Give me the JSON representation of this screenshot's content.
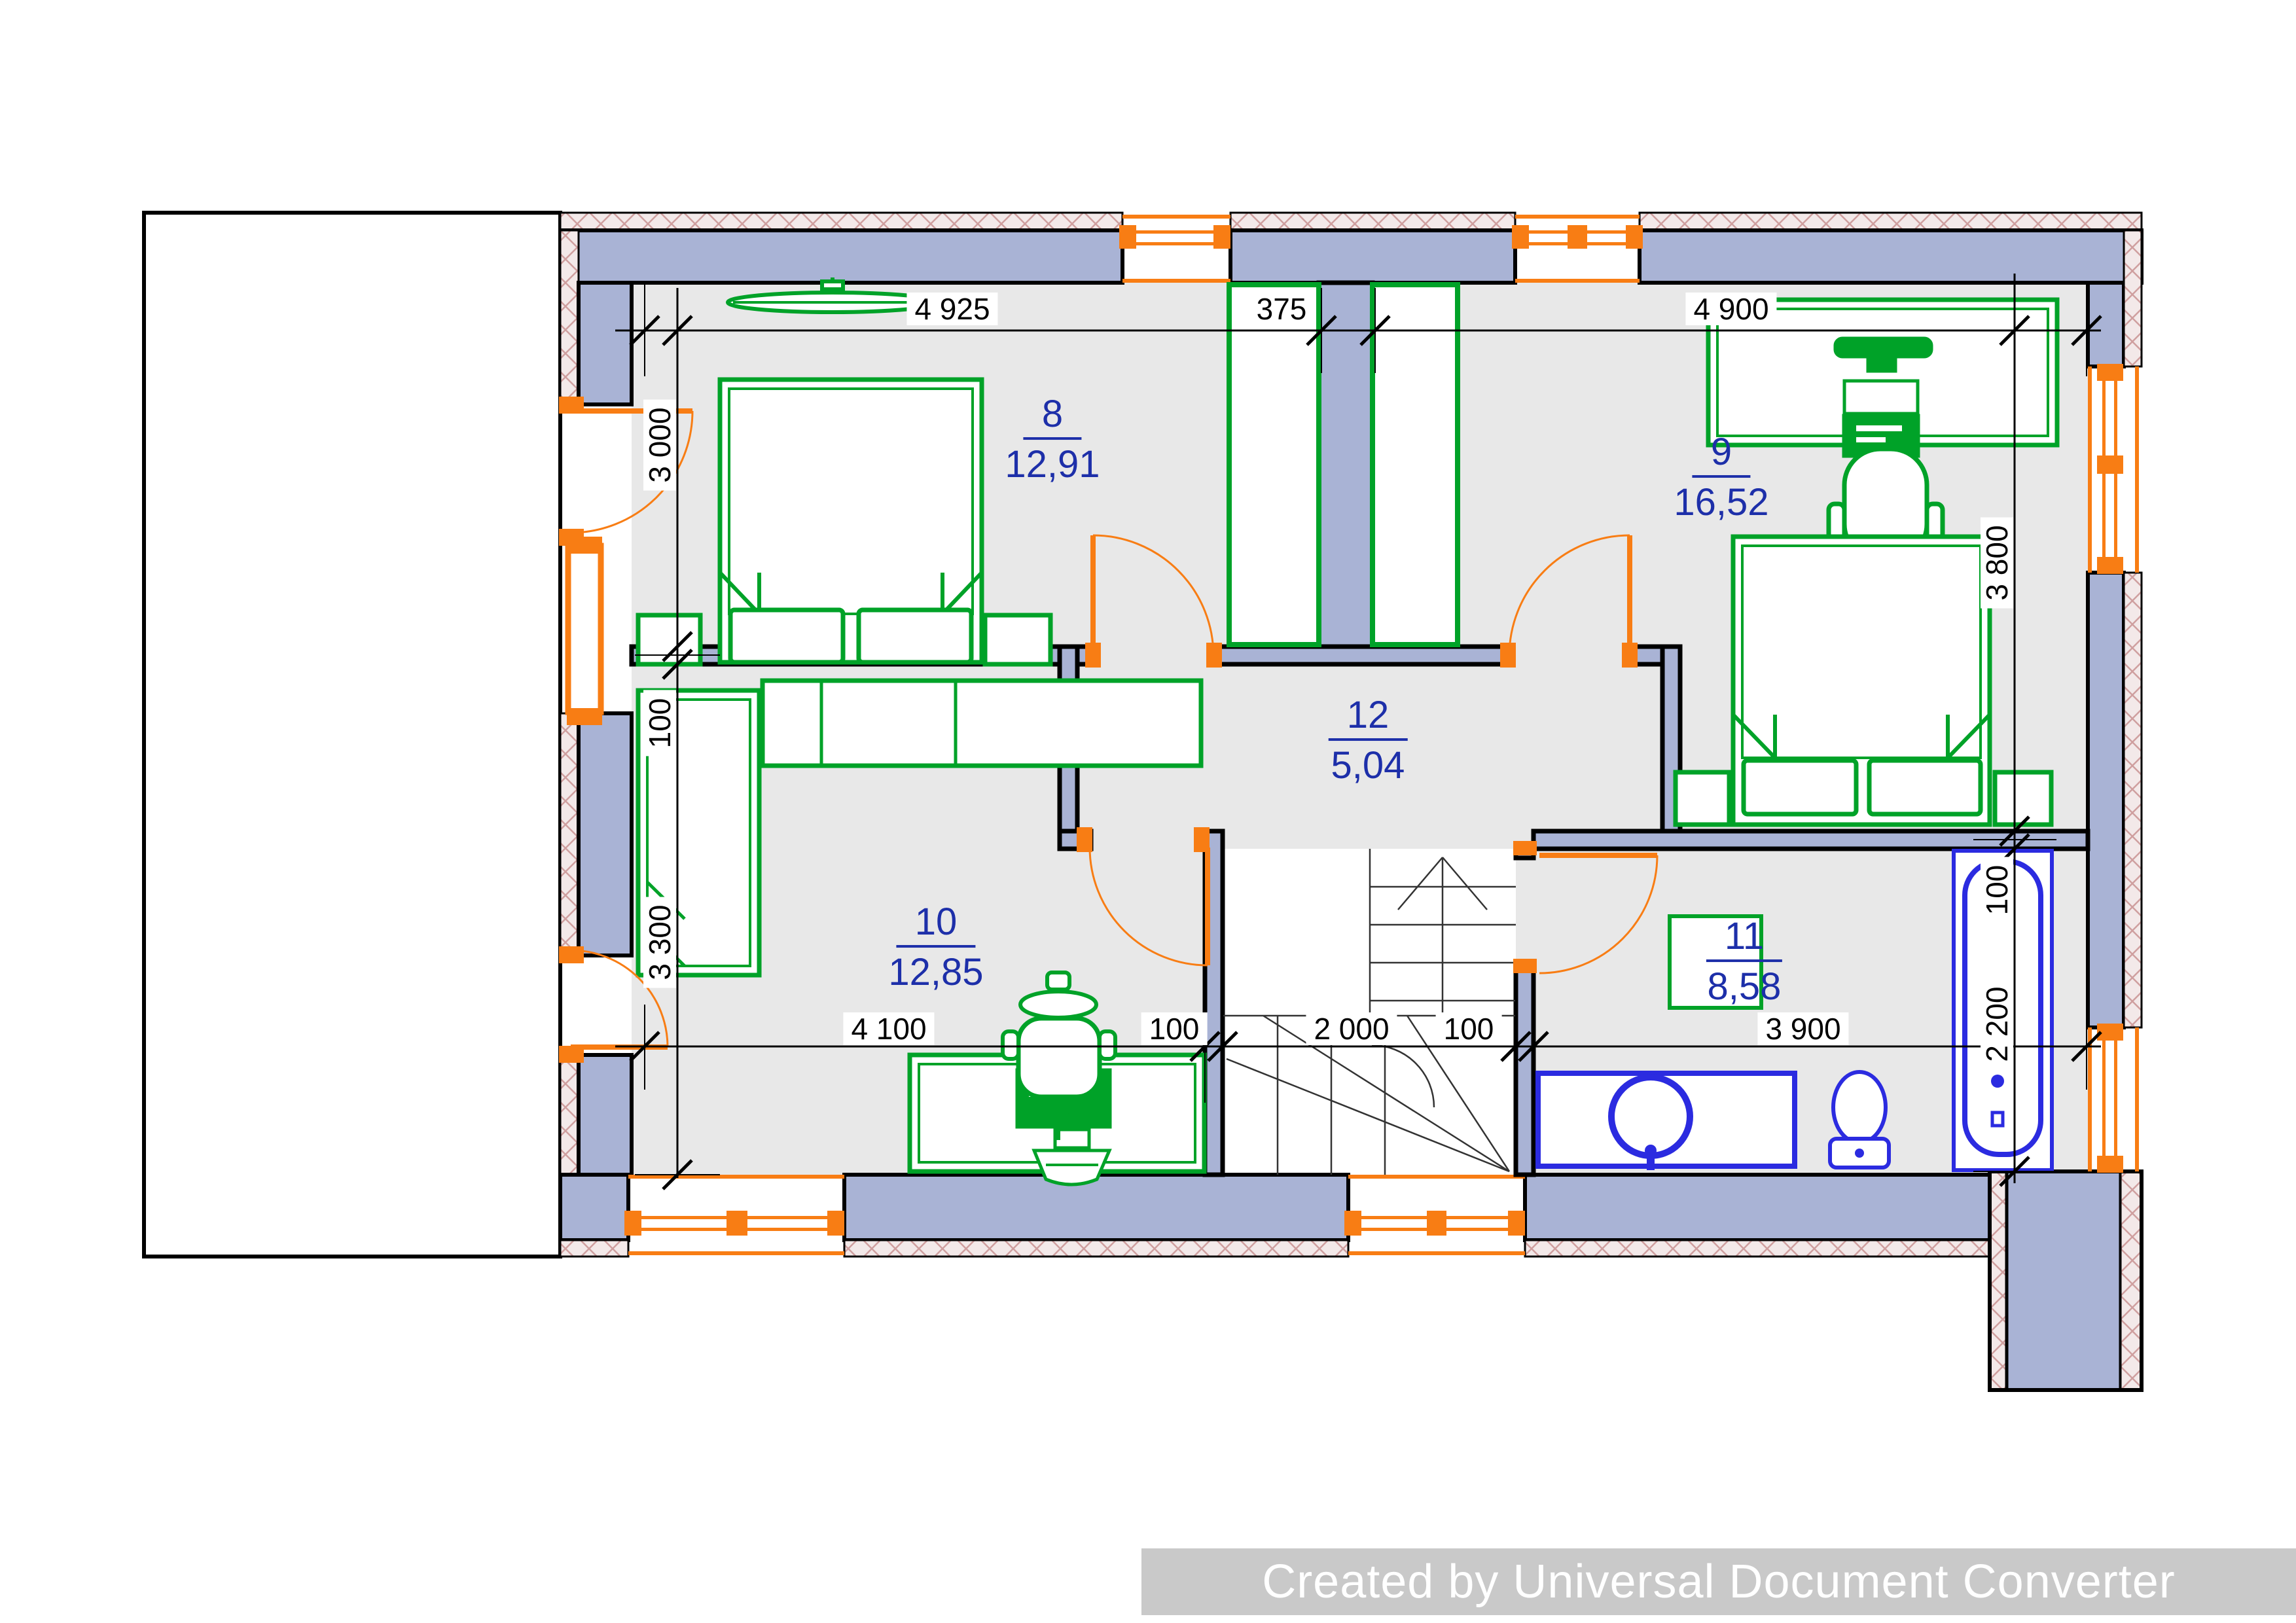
{
  "watermark": {
    "text": "Created by Universal Document Converter"
  },
  "rooms": [
    {
      "number": "8",
      "area": "12,91"
    },
    {
      "number": "9",
      "area": "16,52"
    },
    {
      "number": "10",
      "area": "12,85"
    },
    {
      "number": "11",
      "area": "8,58"
    },
    {
      "number": "12",
      "area": "5,04"
    }
  ],
  "dims": {
    "top": [
      "4 925",
      "375",
      "4 900"
    ],
    "bottom": [
      "4 100",
      "100",
      "2 000",
      "100",
      "3 900"
    ],
    "left": [
      "3 000",
      "100",
      "3 300"
    ],
    "right": [
      "3 800",
      "100",
      "2 200"
    ]
  },
  "colors": {
    "wall_fill": "#a9b3d5",
    "insulation_hatch": "#f3e9e9",
    "floor": "#e8e8e8",
    "furniture_green": "#00a228",
    "sanitary_blue": "#2b2be0",
    "frame_orange": "#f87d14",
    "room_label_blue": "#1d2fa9",
    "watermark_bg": "#c9c9c9"
  }
}
